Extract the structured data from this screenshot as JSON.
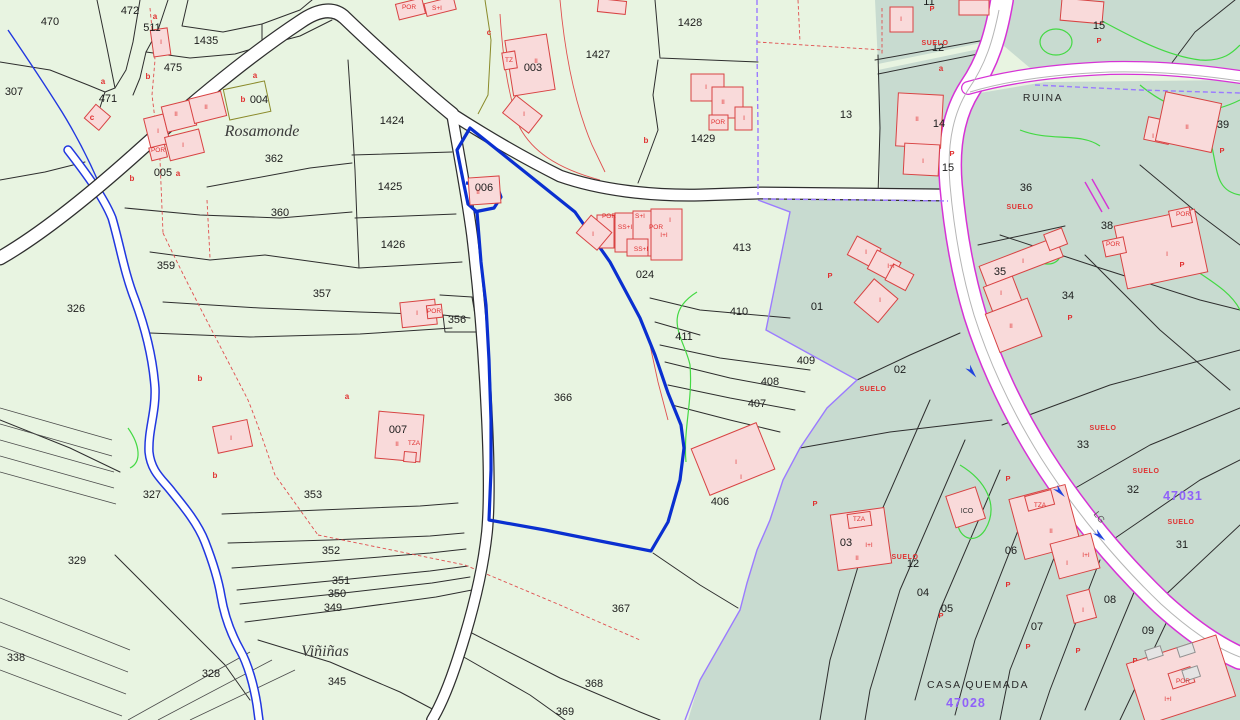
{
  "map": {
    "type": "cadastral-parcel-map",
    "colors": {
      "background_green": "#e8f4e1",
      "zone_teal": "#c8dbd0",
      "selected_parcel_blue": "#0a2fd0",
      "building_fill": "#f9dada",
      "building_stroke": "#d84343",
      "road_magenta": "#d633d6",
      "admin_violet": "#9b7bff",
      "annotation_red": "#e03030",
      "reference_purple": "#9061f9",
      "contour_green": "#43d943",
      "stream_blue": "#2137e0"
    },
    "selected_parcel": "366",
    "place_names": [
      "Rosamonde",
      "Viñiñas",
      "RUINA",
      "CASA QUEMADA"
    ],
    "reference_numbers": [
      "47031",
      "47028"
    ],
    "road_code": "LG",
    "labels": [
      {
        "t": "470",
        "x": 50,
        "y": 25,
        "c": "num"
      },
      {
        "t": "472",
        "x": 130,
        "y": 14,
        "c": "num"
      },
      {
        "t": "511",
        "x": 152,
        "y": 31,
        "c": "num"
      },
      {
        "t": "1435",
        "x": 206,
        "y": 44,
        "c": "num"
      },
      {
        "t": "475",
        "x": 173,
        "y": 71,
        "c": "num"
      },
      {
        "t": "471",
        "x": 108,
        "y": 102,
        "c": "num"
      },
      {
        "t": "307",
        "x": 14,
        "y": 95,
        "c": "num"
      },
      {
        "t": "004",
        "x": 259,
        "y": 103,
        "c": "num"
      },
      {
        "t": "005",
        "x": 163,
        "y": 176,
        "c": "num"
      },
      {
        "t": "362",
        "x": 274,
        "y": 162,
        "c": "num"
      },
      {
        "t": "360",
        "x": 280,
        "y": 216,
        "c": "num"
      },
      {
        "t": "1424",
        "x": 392,
        "y": 124,
        "c": "num"
      },
      {
        "t": "1425",
        "x": 390,
        "y": 190,
        "c": "num"
      },
      {
        "t": "1426",
        "x": 393,
        "y": 248,
        "c": "num"
      },
      {
        "t": "359",
        "x": 166,
        "y": 269,
        "c": "num"
      },
      {
        "t": "357",
        "x": 322,
        "y": 297,
        "c": "num"
      },
      {
        "t": "356",
        "x": 457,
        "y": 323,
        "c": "num"
      },
      {
        "t": "326",
        "x": 76,
        "y": 312,
        "c": "num"
      },
      {
        "t": "327",
        "x": 152,
        "y": 498,
        "c": "num"
      },
      {
        "t": "329",
        "x": 77,
        "y": 564,
        "c": "num"
      },
      {
        "t": "338",
        "x": 16,
        "y": 661,
        "c": "num"
      },
      {
        "t": "328",
        "x": 211,
        "y": 677,
        "c": "num"
      },
      {
        "t": "345",
        "x": 337,
        "y": 685,
        "c": "num"
      },
      {
        "t": "353",
        "x": 313,
        "y": 498,
        "c": "num"
      },
      {
        "t": "352",
        "x": 331,
        "y": 554,
        "c": "num"
      },
      {
        "t": "351",
        "x": 341,
        "y": 584,
        "c": "num"
      },
      {
        "t": "350",
        "x": 337,
        "y": 597,
        "c": "num"
      },
      {
        "t": "349",
        "x": 333,
        "y": 611,
        "c": "num"
      },
      {
        "t": "366",
        "x": 563,
        "y": 401,
        "c": "num"
      },
      {
        "t": "367",
        "x": 621,
        "y": 612,
        "c": "num"
      },
      {
        "t": "368",
        "x": 594,
        "y": 687,
        "c": "num"
      },
      {
        "t": "369",
        "x": 565,
        "y": 715,
        "c": "num"
      },
      {
        "t": "003",
        "x": 533,
        "y": 71,
        "c": "num"
      },
      {
        "t": "006",
        "x": 484,
        "y": 191,
        "c": "num"
      },
      {
        "t": "007",
        "x": 398,
        "y": 433,
        "c": "num"
      },
      {
        "t": "024",
        "x": 645,
        "y": 278,
        "c": "num"
      },
      {
        "t": "413",
        "x": 742,
        "y": 251,
        "c": "num"
      },
      {
        "t": "410",
        "x": 739,
        "y": 315,
        "c": "num"
      },
      {
        "t": "411",
        "x": 684,
        "y": 340,
        "c": "num"
      },
      {
        "t": "409",
        "x": 806,
        "y": 364,
        "c": "num"
      },
      {
        "t": "408",
        "x": 770,
        "y": 385,
        "c": "num"
      },
      {
        "t": "407",
        "x": 757,
        "y": 407,
        "c": "num"
      },
      {
        "t": "406",
        "x": 720,
        "y": 505,
        "c": "num"
      },
      {
        "t": "1427",
        "x": 598,
        "y": 58,
        "c": "num"
      },
      {
        "t": "1428",
        "x": 690,
        "y": 26,
        "c": "num"
      },
      {
        "t": "1429",
        "x": 703,
        "y": 142,
        "c": "num"
      },
      {
        "t": "13",
        "x": 846,
        "y": 118,
        "c": "num"
      },
      {
        "t": "14",
        "x": 939,
        "y": 127,
        "c": "num"
      },
      {
        "t": "15",
        "x": 948,
        "y": 171,
        "c": "num"
      },
      {
        "t": "15",
        "x": 1099,
        "y": 29,
        "c": "num"
      },
      {
        "t": "12",
        "x": 938,
        "y": 51,
        "c": "num"
      },
      {
        "t": "11",
        "x": 929,
        "y": 5,
        "c": "num"
      },
      {
        "t": "36",
        "x": 1026,
        "y": 191,
        "c": "num"
      },
      {
        "t": "35",
        "x": 1000,
        "y": 275,
        "c": "num"
      },
      {
        "t": "34",
        "x": 1068,
        "y": 299,
        "c": "num"
      },
      {
        "t": "38",
        "x": 1107,
        "y": 229,
        "c": "num"
      },
      {
        "t": "39",
        "x": 1223,
        "y": 128,
        "c": "num"
      },
      {
        "t": "01",
        "x": 817,
        "y": 310,
        "c": "num"
      },
      {
        "t": "02",
        "x": 900,
        "y": 373,
        "c": "num"
      },
      {
        "t": "03",
        "x": 846,
        "y": 546,
        "c": "num"
      },
      {
        "t": "12",
        "x": 913,
        "y": 567,
        "c": "num"
      },
      {
        "t": "04",
        "x": 923,
        "y": 596,
        "c": "num"
      },
      {
        "t": "05",
        "x": 947,
        "y": 612,
        "c": "num"
      },
      {
        "t": "06",
        "x": 1011,
        "y": 554,
        "c": "num"
      },
      {
        "t": "07",
        "x": 1037,
        "y": 630,
        "c": "num"
      },
      {
        "t": "08",
        "x": 1110,
        "y": 603,
        "c": "num"
      },
      {
        "t": "09",
        "x": 1148,
        "y": 634,
        "c": "num"
      },
      {
        "t": "33",
        "x": 1083,
        "y": 448,
        "c": "num"
      },
      {
        "t": "32",
        "x": 1133,
        "y": 493,
        "c": "num"
      },
      {
        "t": "31",
        "x": 1182,
        "y": 548,
        "c": "num"
      },
      {
        "t": "SUELO",
        "x": 935,
        "y": 45,
        "c": "suelo"
      },
      {
        "t": "SUELO",
        "x": 1020,
        "y": 209,
        "c": "suelo"
      },
      {
        "t": "SUELO",
        "x": 873,
        "y": 391,
        "c": "suelo"
      },
      {
        "t": "SUELO",
        "x": 905,
        "y": 559,
        "c": "suelo"
      },
      {
        "t": "SUELO",
        "x": 1103,
        "y": 430,
        "c": "suelo"
      },
      {
        "t": "SUELO",
        "x": 1146,
        "y": 473,
        "c": "suelo"
      },
      {
        "t": "SUELO",
        "x": 1181,
        "y": 524,
        "c": "suelo"
      },
      {
        "t": "a",
        "x": 155,
        "y": 19,
        "c": "letter"
      },
      {
        "t": "a",
        "x": 103,
        "y": 84,
        "c": "letter"
      },
      {
        "t": "a",
        "x": 178,
        "y": 176,
        "c": "letter"
      },
      {
        "t": "a",
        "x": 255,
        "y": 78,
        "c": "letter"
      },
      {
        "t": "a",
        "x": 347,
        "y": 399,
        "c": "letter"
      },
      {
        "t": "a",
        "x": 941,
        "y": 71,
        "c": "letter"
      },
      {
        "t": "b",
        "x": 148,
        "y": 79,
        "c": "letter"
      },
      {
        "t": "b",
        "x": 132,
        "y": 181,
        "c": "letter"
      },
      {
        "t": "b",
        "x": 243,
        "y": 102,
        "c": "letter"
      },
      {
        "t": "b",
        "x": 200,
        "y": 381,
        "c": "letter"
      },
      {
        "t": "b",
        "x": 215,
        "y": 478,
        "c": "letter"
      },
      {
        "t": "b",
        "x": 646,
        "y": 143,
        "c": "letter"
      },
      {
        "t": "c",
        "x": 92,
        "y": 120,
        "c": "letter"
      },
      {
        "t": "c",
        "x": 489,
        "y": 35,
        "c": "letter"
      },
      {
        "t": "P",
        "x": 932,
        "y": 11,
        "c": "p"
      },
      {
        "t": "P",
        "x": 952,
        "y": 156,
        "c": "p"
      },
      {
        "t": "P",
        "x": 1099,
        "y": 43,
        "c": "p"
      },
      {
        "t": "P",
        "x": 1222,
        "y": 153,
        "c": "p"
      },
      {
        "t": "P",
        "x": 1182,
        "y": 267,
        "c": "p"
      },
      {
        "t": "P",
        "x": 1070,
        "y": 320,
        "c": "p"
      },
      {
        "t": "P",
        "x": 830,
        "y": 278,
        "c": "p"
      },
      {
        "t": "P",
        "x": 815,
        "y": 506,
        "c": "p"
      },
      {
        "t": "P",
        "x": 1008,
        "y": 481,
        "c": "p"
      },
      {
        "t": "P",
        "x": 1008,
        "y": 587,
        "c": "p"
      },
      {
        "t": "P",
        "x": 941,
        "y": 618,
        "c": "p"
      },
      {
        "t": "P",
        "x": 1028,
        "y": 649,
        "c": "p"
      },
      {
        "t": "P",
        "x": 1078,
        "y": 653,
        "c": "p"
      },
      {
        "t": "P",
        "x": 1135,
        "y": 663,
        "c": "p"
      },
      {
        "t": "I",
        "x": 158,
        "y": 133,
        "c": "bm"
      },
      {
        "t": "II",
        "x": 176,
        "y": 116,
        "c": "bm"
      },
      {
        "t": "I",
        "x": 183,
        "y": 147,
        "c": "bm"
      },
      {
        "t": "POR",
        "x": 158,
        "y": 152,
        "c": "bm"
      },
      {
        "t": "II",
        "x": 206,
        "y": 109,
        "c": "bm"
      },
      {
        "t": "I",
        "x": 161,
        "y": 44,
        "c": "bm"
      },
      {
        "t": "TZ",
        "x": 509,
        "y": 62,
        "c": "bm"
      },
      {
        "t": "II",
        "x": 536,
        "y": 63,
        "c": "bm"
      },
      {
        "t": "I",
        "x": 524,
        "y": 116,
        "c": "bm"
      },
      {
        "t": "II",
        "x": 478,
        "y": 194,
        "c": "bm"
      },
      {
        "t": "I",
        "x": 706,
        "y": 89,
        "c": "bm"
      },
      {
        "t": "II",
        "x": 723,
        "y": 104,
        "c": "bm"
      },
      {
        "t": "POR",
        "x": 718,
        "y": 124,
        "c": "bm"
      },
      {
        "t": "I",
        "x": 744,
        "y": 120,
        "c": "bm"
      },
      {
        "t": "POR",
        "x": 609,
        "y": 218,
        "c": "bm"
      },
      {
        "t": "S+I",
        "x": 640,
        "y": 218,
        "c": "bm"
      },
      {
        "t": "SS+I",
        "x": 625,
        "y": 229,
        "c": "bm"
      },
      {
        "t": "POR",
        "x": 656,
        "y": 229,
        "c": "bm"
      },
      {
        "t": "I+I",
        "x": 664,
        "y": 237,
        "c": "bm"
      },
      {
        "t": "SS+I",
        "x": 641,
        "y": 251,
        "c": "bm"
      },
      {
        "t": "I",
        "x": 670,
        "y": 222,
        "c": "bm"
      },
      {
        "t": "I",
        "x": 593,
        "y": 236,
        "c": "bm"
      },
      {
        "t": "I",
        "x": 417,
        "y": 315,
        "c": "bm"
      },
      {
        "t": "POR",
        "x": 434,
        "y": 313,
        "c": "bm"
      },
      {
        "t": "II",
        "x": 397,
        "y": 446,
        "c": "bm"
      },
      {
        "t": "TZA",
        "x": 414,
        "y": 445,
        "c": "bm"
      },
      {
        "t": "I",
        "x": 231,
        "y": 440,
        "c": "bm"
      },
      {
        "t": "I",
        "x": 736,
        "y": 464,
        "c": "bm"
      },
      {
        "t": "I",
        "x": 741,
        "y": 479,
        "c": "bm"
      },
      {
        "t": "II",
        "x": 917,
        "y": 121,
        "c": "bm"
      },
      {
        "t": "I",
        "x": 923,
        "y": 163,
        "c": "bm"
      },
      {
        "t": "I",
        "x": 866,
        "y": 254,
        "c": "bm"
      },
      {
        "t": "I+I",
        "x": 891,
        "y": 268,
        "c": "bm"
      },
      {
        "t": "I",
        "x": 880,
        "y": 302,
        "c": "bm"
      },
      {
        "t": "I",
        "x": 1023,
        "y": 263,
        "c": "bm"
      },
      {
        "t": "I",
        "x": 1001,
        "y": 295,
        "c": "bm"
      },
      {
        "t": "II",
        "x": 1011,
        "y": 328,
        "c": "bm"
      },
      {
        "t": "I",
        "x": 1167,
        "y": 256,
        "c": "bm"
      },
      {
        "t": "POR",
        "x": 1183,
        "y": 216,
        "c": "bm"
      },
      {
        "t": "POR",
        "x": 1113,
        "y": 246,
        "c": "bm"
      },
      {
        "t": "I",
        "x": 1153,
        "y": 138,
        "c": "bm"
      },
      {
        "t": "II",
        "x": 1187,
        "y": 129,
        "c": "bm"
      },
      {
        "t": "TZA",
        "x": 1040,
        "y": 507,
        "c": "bm"
      },
      {
        "t": "II",
        "x": 1051,
        "y": 533,
        "c": "bm"
      },
      {
        "t": "I",
        "x": 1067,
        "y": 565,
        "c": "bm"
      },
      {
        "t": "I+I",
        "x": 1086,
        "y": 557,
        "c": "bm"
      },
      {
        "t": "I",
        "x": 1083,
        "y": 612,
        "c": "bm"
      },
      {
        "t": "TZA",
        "x": 859,
        "y": 521,
        "c": "bm"
      },
      {
        "t": "I+I",
        "x": 869,
        "y": 547,
        "c": "bm"
      },
      {
        "t": "II",
        "x": 857,
        "y": 560,
        "c": "bm"
      },
      {
        "t": "POR",
        "x": 1183,
        "y": 683,
        "c": "bm"
      },
      {
        "t": "I+I",
        "x": 1168,
        "y": 701,
        "c": "bm"
      },
      {
        "t": "I",
        "x": 901,
        "y": 21,
        "c": "bm"
      },
      {
        "t": "POR",
        "x": 409,
        "y": 9,
        "c": "bm"
      },
      {
        "t": "S+I",
        "x": 437,
        "y": 10,
        "c": "bm"
      },
      {
        "t": "ICO",
        "x": 967,
        "y": 513,
        "c": "bms"
      },
      {
        "t": "Rosamonde",
        "x": 262,
        "y": 136,
        "c": "serif"
      },
      {
        "t": "Viñiñas",
        "x": 325,
        "y": 656,
        "c": "serif"
      },
      {
        "t": "RUINA",
        "x": 1043,
        "y": 101,
        "c": "caps"
      },
      {
        "t": "CASA QUEMADA",
        "x": 978,
        "y": 688,
        "c": "caps"
      },
      {
        "t": "47031",
        "x": 1183,
        "y": 500,
        "c": "ref"
      },
      {
        "t": "47028",
        "x": 966,
        "y": 707,
        "c": "ref"
      },
      {
        "t": "LG",
        "x": 1097,
        "y": 519,
        "c": "road",
        "r": 52
      }
    ]
  }
}
